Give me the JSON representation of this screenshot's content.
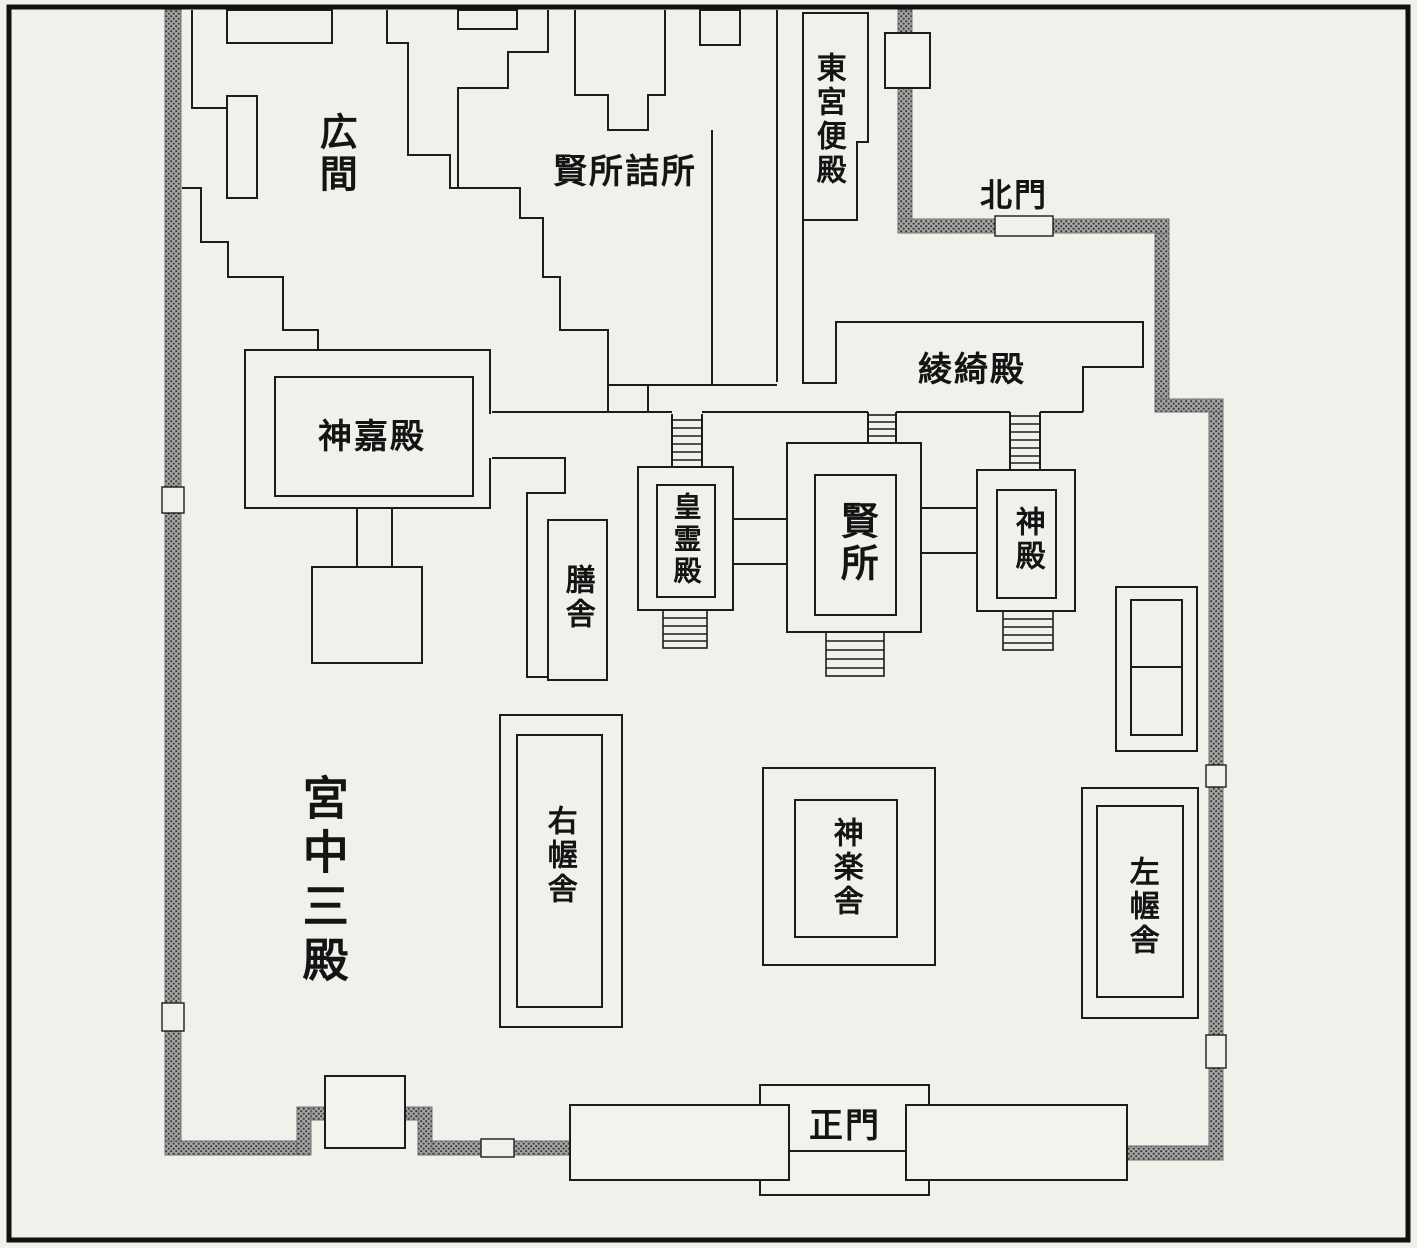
{
  "figure": {
    "type": "architectural-floor-plan",
    "script": "japanese"
  },
  "colors": {
    "background": "#f2f0ea",
    "line": "#1c1c1c",
    "wall_base": "#a6a6a6",
    "wall_dot": "#3a3a3a",
    "page_border": "#111111"
  },
  "labels": {
    "hiroma": "広間",
    "kashikodokoro_tsumesho": "賢所詰所",
    "togu_benden": "東宮便殿",
    "hokumon": "北門",
    "ryokiden": "綾綺殿",
    "shinkaden": "神嘉殿",
    "zensha": "膳舎",
    "koreiden": "皇霊殿",
    "kashikodokoro": "賢所",
    "shinden": "神殿",
    "u_akusha": "右幄舎",
    "kagurasha": "神楽舎",
    "sa_akusha": "左幄舎",
    "kyuchu_sanden": "宮中三殿",
    "seimon": "正門"
  }
}
